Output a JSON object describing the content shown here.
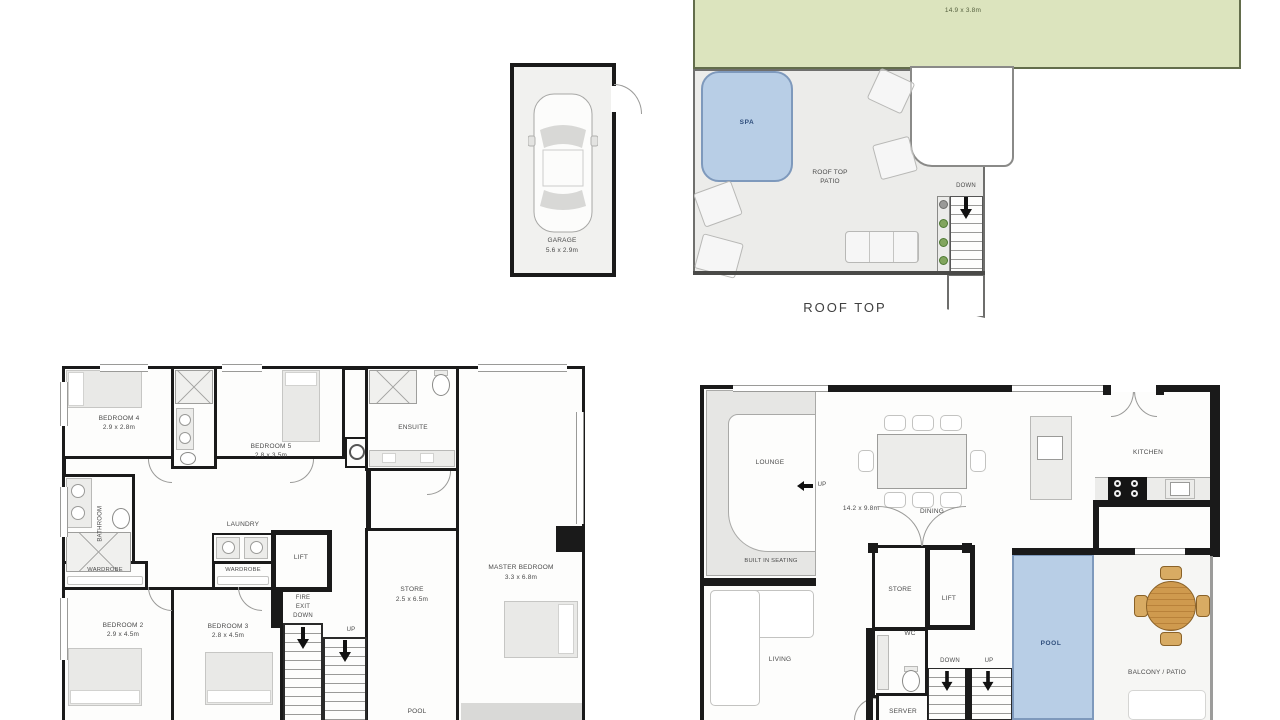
{
  "rooftop": {
    "title": "ROOF TOP",
    "garden_label": "ROOF TOP GARDEN",
    "garden_dims": "14.9 x 3.8m",
    "spa_label": "SPA",
    "patio_label_1": "ROOF TOP",
    "patio_label_2": "PATIO",
    "down_label": "DOWN"
  },
  "garage": {
    "label": "GARAGE",
    "dims": "5.6 x 2.9m"
  },
  "bedroom_floor": {
    "bedroom4_name": "BEDROOM 4",
    "bedroom4_dims": "2.9 x 2.8m",
    "bedroom5_name": "BEDROOM 5",
    "bedroom5_dims": "2.8 x 3.5m",
    "bedroom2_name": "BEDROOM 2",
    "bedroom2_dims": "2.9 x 4.5m",
    "bedroom3_name": "BEDROOM 3",
    "bedroom3_dims": "2.8 x 4.5m",
    "master_name": "MASTER BEDROOM",
    "master_dims": "3.3 x 6.8m",
    "bathroom": "BATHROOM",
    "wardrobe_left": "WARDROBE",
    "wardrobe_right": "WARDROBE",
    "laundry": "LAUNDRY",
    "lift": "LIFT",
    "ensuite": "ENSUITE",
    "store_name": "STORE",
    "store_dims": "2.5 x 6.5m",
    "fire_exit_1": "FIRE",
    "fire_exit_2": "EXIT",
    "fire_exit_3": "DOWN",
    "up": "UP",
    "pool": "POOL"
  },
  "living_floor": {
    "lounge": "LOUNGE",
    "up": "UP",
    "built_in_seating": "BUILT IN SEATING",
    "overall_dims": "14.2 x 9.8m",
    "dining": "DINING",
    "kitchen": "KITCHEN",
    "living": "LIVING",
    "store": "STORE",
    "lift": "LIFT",
    "wc": "WC",
    "down": "DOWN",
    "up_stairs": "UP",
    "server": "SERVER",
    "pool": "POOL",
    "balcony": "BALCONY / PATIO"
  },
  "colors": {
    "garden": "#dce4be",
    "water": "#b8cee6",
    "patio": "#ececea",
    "wall": "#1a1a1a",
    "text": "#4a4a4a",
    "water_text": "#2e4d7b",
    "plant": "#82a55e",
    "wood": "#cf9a4e"
  }
}
